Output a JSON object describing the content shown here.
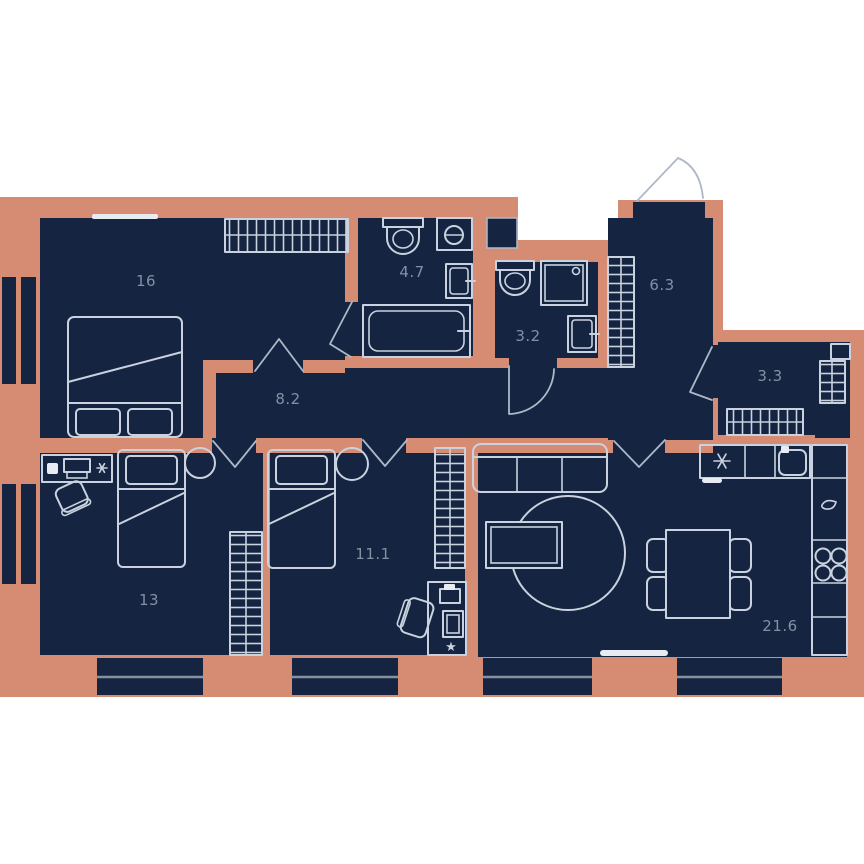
{
  "plan": {
    "title": "3-room apartment floor plan",
    "rooms": [
      {
        "id": "bedroom-main",
        "area": "16"
      },
      {
        "id": "bathroom",
        "area": "4.7"
      },
      {
        "id": "wc",
        "area": "3.2"
      },
      {
        "id": "hallway",
        "area": "6.3"
      },
      {
        "id": "pantry",
        "area": "3.3"
      },
      {
        "id": "corridor",
        "area": "8.2"
      },
      {
        "id": "bedroom-2",
        "area": "11.1"
      },
      {
        "id": "bedroom-3",
        "area": "13"
      },
      {
        "id": "living-kitchen",
        "area": "21.6"
      }
    ],
    "colors": {
      "bg": "#ffffff",
      "wall": "#d68c73",
      "room": "#152440",
      "line": "#c9d2de",
      "frame": "#e8ecf2",
      "door": "#aeb9c8",
      "label": "#8590a4",
      "window": "#87909f"
    }
  }
}
